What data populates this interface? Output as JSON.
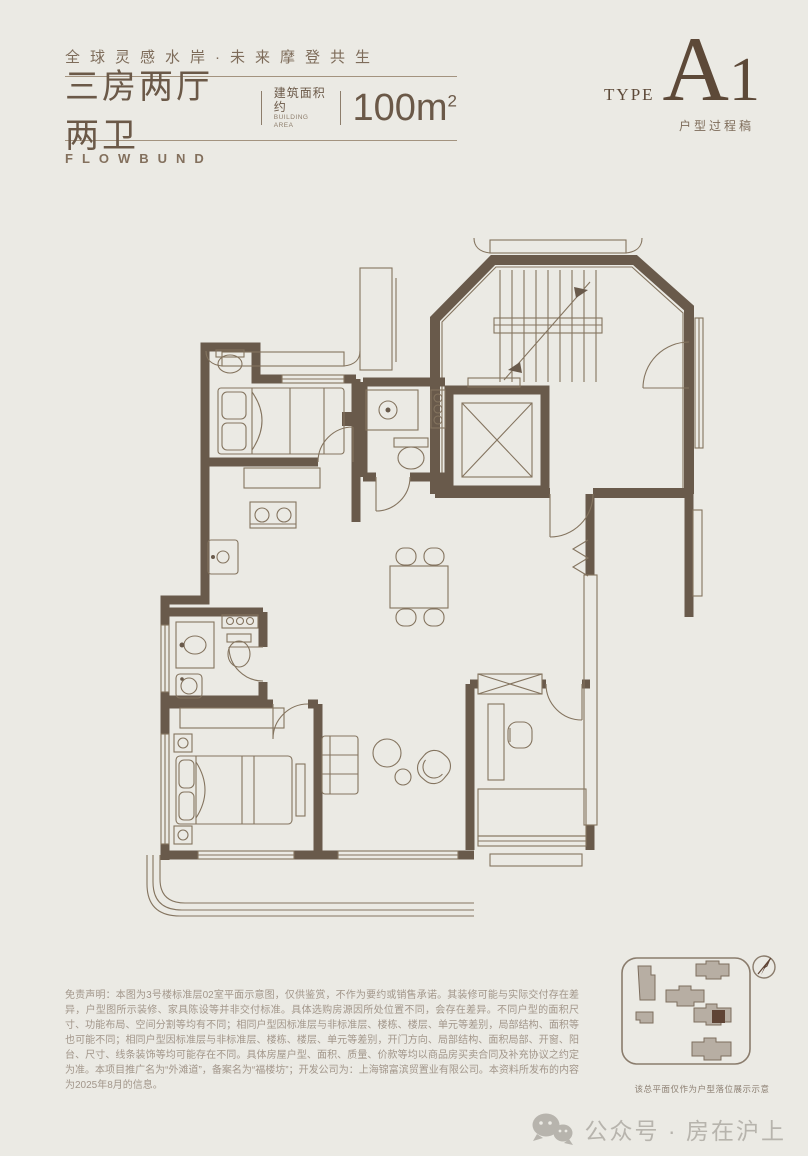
{
  "colors": {
    "paper": "#ebeae4",
    "wall": "#695a4b",
    "thin_line": "#84745f",
    "brand_brown": "#6b5948",
    "accent_serif": "#5d4938",
    "sitemap_highlight": "#5f4435",
    "watermark_gray": "#b7b4ad"
  },
  "header": {
    "slogan": "全球灵感水岸·未来摩登共生",
    "title": "三房两厅两卫",
    "area_label_cn": "建筑面积约",
    "area_label_en": "BUILDING AREA",
    "area_value": "100m",
    "area_sup": "2",
    "brand": "FLOWBUND",
    "type_label": "TYPE",
    "type_letter": "A",
    "type_digit": "1",
    "type_note": "户型过程稿"
  },
  "floorplan": {
    "description": "三房两厅两卫户型平面图，含楼梯间、电梯、玄关、厨房、餐厅、客厅、书房、主卧、次卧、两卫及转角阳台"
  },
  "footer": {
    "disclaimer": "免责声明：本图为3号楼标准层02室平面示意图，仅供鉴赏，不作为要约或销售承诺。其装修可能与实际交付存在差异，户型图所示装修、家具陈设等并非交付标准。具体选购房源因所处位置不同，会存在差异。不同户型的面积尺寸、功能布局、空间分割等均有不同；相同户型因标准层与非标准层、楼栋、楼层、单元等差别，局部结构、面积等也可能不同；相同户型因标准层与非标准层、楼栋、楼层、单元等差别，开门方向、局部结构、面积局部、开窗、阳台、尺寸、线条装饰等均可能存在不同。具体房屋户型、面积、质量、价款等均以商品房买卖合同及补充协议之约定为准。本项目推广名为“外滩道”，备案名为“福楼坊”；开发公司为：上海锦富滨贸置业有限公司。本资料所发布的内容为2025年8月的信息。",
    "sitemap_caption": "该总平面仅作为户型落位展示示意",
    "watermark": "公众号 · 房在沪上"
  }
}
